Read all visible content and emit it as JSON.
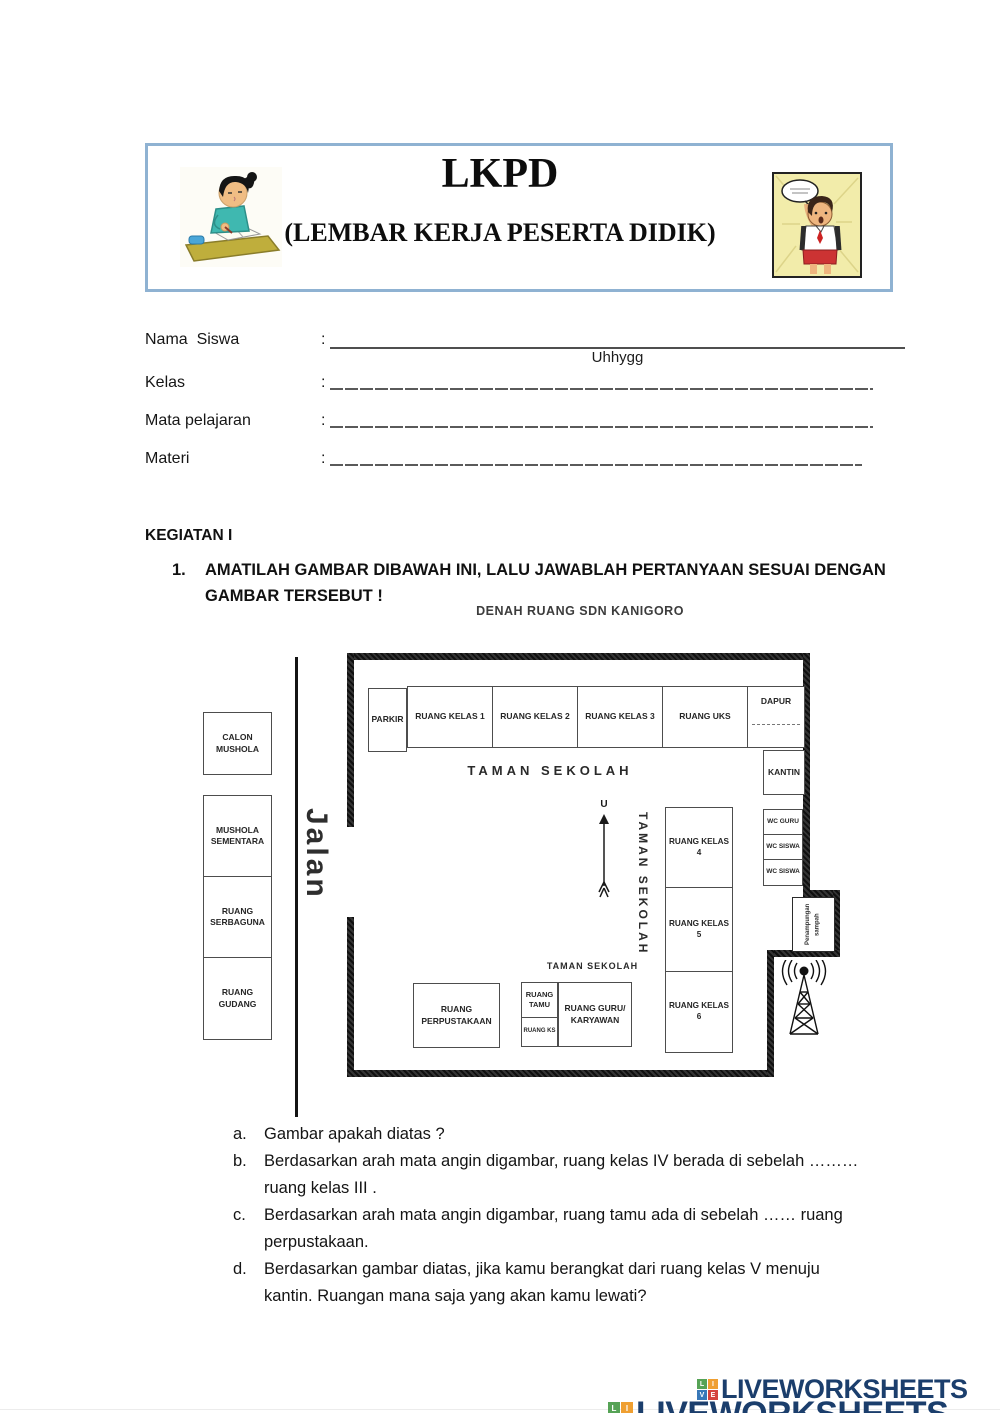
{
  "header": {
    "title": "LKPD",
    "subtitle": "(LEMBAR KERJA PESERTA DIDIK)"
  },
  "form": {
    "colon": ":",
    "fields": [
      {
        "label": "Nama  Siswa",
        "value": "Uhhygg"
      },
      {
        "label": "Kelas",
        "value": ""
      },
      {
        "label": "Mata pelajaran",
        "value": ""
      },
      {
        "label": "Materi",
        "value": ""
      }
    ]
  },
  "activity": {
    "heading": "KEGIATAN I",
    "number": "1.",
    "line1": "AMATILAH GAMBAR DIBAWAH INI, LALU JAWABLAH PERTANYAAN SESUAI DENGAN",
    "line2": "GAMBAR TERSEBUT !"
  },
  "floorplan": {
    "title": "DENAH RUANG SDN KANIGORO",
    "road": "Jalan",
    "compass": "U",
    "outside": {
      "calon_mushola": "CALON MUSHOLA",
      "mushola_sementara": "MUSHOLA SEMENTARA",
      "ruang_serbaguna": "RUANG SERBAGUNA",
      "ruang_gudang": "RUANG GUDANG"
    },
    "top_row": {
      "parkir": "PARKIR",
      "kelas1": "RUANG KELAS 1",
      "kelas2": "RUANG KELAS 2",
      "kelas3": "RUANG KELAS 3",
      "uks": "RUANG UKS",
      "dapur": "DAPUR"
    },
    "garden_main": "TAMAN SEKOLAH",
    "garden_vertical": "TAMAN SEKOLAH",
    "garden_small": "TAMAN SEKOLAH",
    "right_col": {
      "kantin": "KANTIN",
      "wc_guru": "WC GURU",
      "wc_siswa1": "WC SISWA",
      "wc_siswa2": "WC SISWA"
    },
    "class_col": {
      "kelas4": "RUANG KELAS 4",
      "kelas5": "RUANG KELAS 5",
      "kelas6": "RUANG KELAS 6"
    },
    "bottom_row": {
      "perpustakaan": "RUANG PERPUSTAKAAN",
      "tamu": "RUANG TAMU",
      "ks": "RUANG KS",
      "guru": "RUANG GURU/ KARYAWAN"
    },
    "waste": "Penampungan sampah"
  },
  "questions": [
    {
      "letter": "a.",
      "l1": "Gambar apakah diatas ?",
      "l2": ""
    },
    {
      "letter": "b.",
      "l1": "Berdasarkan arah mata angin digambar, ruang kelas IV berada di sebelah ………",
      "l2": "ruang kelas III ."
    },
    {
      "letter": "c.",
      "l1": "Berdasarkan arah mata angin digambar, ruang tamu ada di sebelah …… ruang",
      "l2": "perpustakaan."
    },
    {
      "letter": "d.",
      "l1": "Berdasarkan gambar diatas, jika kamu berangkat dari ruang kelas V menuju",
      "l2": "kantin. Ruangan mana saja yang akan kamu lewati?"
    }
  ],
  "footer": {
    "brand": "LIVEWORKSHEETS",
    "brand_partial": "LIVEWORKSHEETS",
    "squares": {
      "l": "L",
      "i": "I",
      "v": "V",
      "e": "E"
    }
  },
  "colors": {
    "header_border": "#8fb2d2",
    "brand_navy": "#1b3e6c",
    "square_green": "#56a356",
    "square_orange": "#ef9f31",
    "square_blue": "#3878b8",
    "square_red": "#d5423c"
  }
}
